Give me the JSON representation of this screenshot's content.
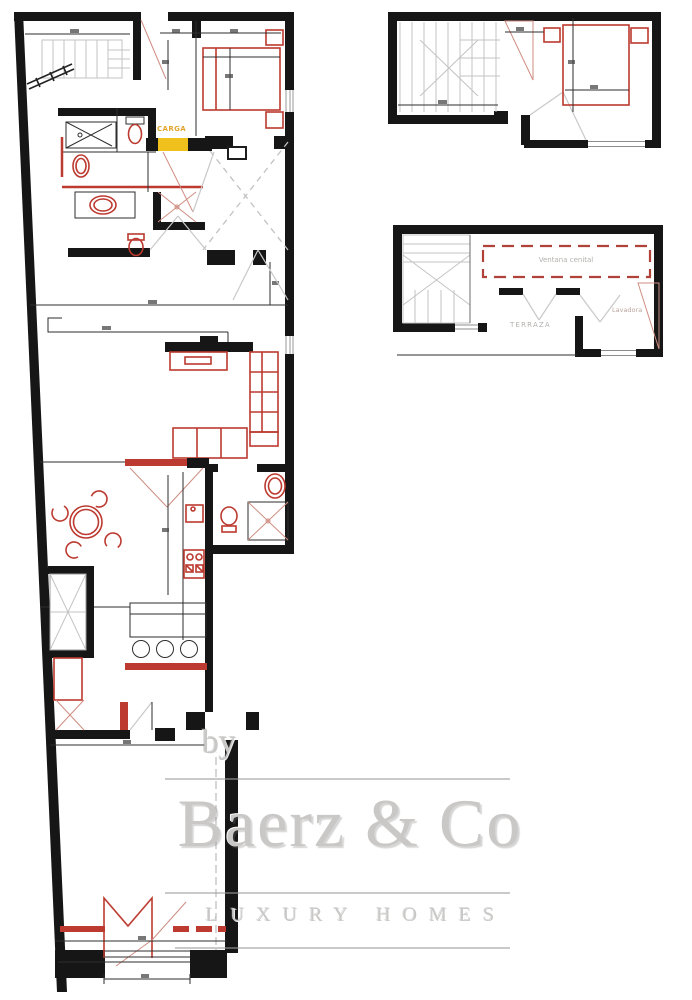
{
  "colors": {
    "background": "#ffffff",
    "wall": "#161616",
    "line": "#2e2e2e",
    "furniture_red": "#bc3a30",
    "light_red": "#cf8d82",
    "stair_gray": "#c3c3c3",
    "swing_gray": "#c9c9c9",
    "dashed_gray": "#c2c2c2",
    "dashed_red": "#b0423a",
    "highlight_yellow": "#f0c11c",
    "carga_text": "#e2a52e",
    "label_gray": "#b3b1ae",
    "lavadora_text": "#bba49e",
    "watermark_gray": "#c9c8c6",
    "watermark_line": "#9c9c9c"
  },
  "labels": {
    "carga": "CARGA",
    "ventana_cenital": "Ventana cenital",
    "terraza": "TERRAZA",
    "lavadora": "Lavadora"
  },
  "watermark": {
    "prefix": "by",
    "brand": "Baerz & Co",
    "tagline": "LUXURY HOMES"
  }
}
